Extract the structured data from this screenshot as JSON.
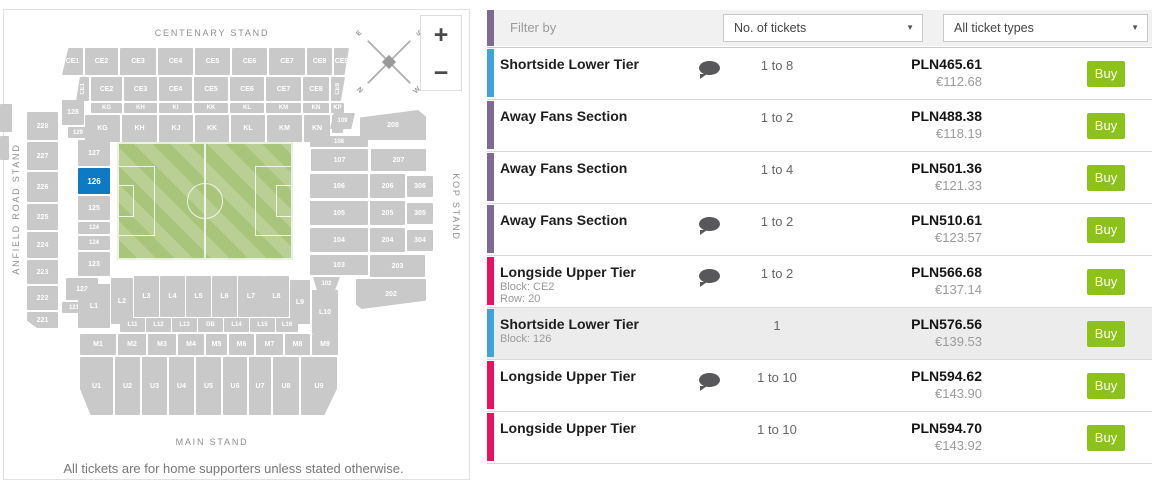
{
  "colors": {
    "buy_green": "#8dc21a",
    "selected_block": "#0e7ac4",
    "block_gray": "#c9c9c9",
    "pitch_green": "#a9c57c",
    "accent_purple": "#7e6b92",
    "accent_blue": "#41a3da",
    "accent_pink": "#e8135f"
  },
  "map": {
    "stands": {
      "top": "CENTENARY STAND",
      "left": "ANFIELD ROAD STAND",
      "right": "KOP STAND",
      "bottom": "MAIN STAND"
    },
    "footer_note": "All tickets are for home supporters unless stated otherwise.",
    "zoom_in": "+",
    "zoom_out": "−",
    "compass": {
      "nw": "E",
      "ne": "S",
      "sw": "N",
      "se": "W"
    },
    "selected_block": "126",
    "blocks": [
      {
        "label": "CE1",
        "x": 62,
        "y": 48,
        "w": 21,
        "h": 27,
        "cls": "sl"
      },
      {
        "label": "CE2",
        "x": 85,
        "y": 48,
        "w": 33,
        "h": 27
      },
      {
        "label": "CE3",
        "x": 120,
        "y": 48,
        "w": 36,
        "h": 27
      },
      {
        "label": "CE4",
        "x": 158,
        "y": 48,
        "w": 35,
        "h": 27
      },
      {
        "label": "CE5",
        "x": 195,
        "y": 48,
        "w": 35,
        "h": 27
      },
      {
        "label": "CE6",
        "x": 232,
        "y": 48,
        "w": 35,
        "h": 27
      },
      {
        "label": "CE7",
        "x": 269,
        "y": 48,
        "w": 36,
        "h": 27
      },
      {
        "label": "CE8",
        "x": 307,
        "y": 48,
        "w": 25,
        "h": 27
      },
      {
        "label": "CE9",
        "x": 334,
        "y": 48,
        "w": 15,
        "h": 27,
        "cls": "sr"
      },
      {
        "label": "CE1",
        "x": 76,
        "y": 77,
        "w": 13,
        "h": 24,
        "cls": "v sl"
      },
      {
        "label": "CE2",
        "x": 91,
        "y": 77,
        "w": 31,
        "h": 24
      },
      {
        "label": "CE3",
        "x": 124,
        "y": 77,
        "w": 33,
        "h": 24
      },
      {
        "label": "CE4",
        "x": 159,
        "y": 77,
        "w": 33,
        "h": 24
      },
      {
        "label": "CE5",
        "x": 194,
        "y": 77,
        "w": 34,
        "h": 24
      },
      {
        "label": "CE6",
        "x": 230,
        "y": 77,
        "w": 34,
        "h": 24
      },
      {
        "label": "CE7",
        "x": 266,
        "y": 77,
        "w": 35,
        "h": 24
      },
      {
        "label": "CE8",
        "x": 303,
        "y": 77,
        "w": 26,
        "h": 24
      },
      {
        "label": "CE9",
        "x": 331,
        "y": 77,
        "w": 14,
        "h": 24,
        "cls": "v sr"
      },
      {
        "label": "KG",
        "x": 91,
        "y": 103,
        "w": 31,
        "h": 10,
        "cls": "tiny"
      },
      {
        "label": "KH",
        "x": 124,
        "y": 103,
        "w": 33,
        "h": 10,
        "cls": "tiny"
      },
      {
        "label": "KI",
        "x": 159,
        "y": 103,
        "w": 33,
        "h": 10,
        "cls": "tiny"
      },
      {
        "label": "KK",
        "x": 194,
        "y": 103,
        "w": 34,
        "h": 10,
        "cls": "tiny"
      },
      {
        "label": "KL",
        "x": 230,
        "y": 103,
        "w": 34,
        "h": 10,
        "cls": "tiny"
      },
      {
        "label": "KM",
        "x": 266,
        "y": 103,
        "w": 35,
        "h": 10,
        "cls": "tiny"
      },
      {
        "label": "KN",
        "x": 303,
        "y": 103,
        "w": 26,
        "h": 10,
        "cls": "tiny"
      },
      {
        "label": "KP",
        "x": 331,
        "y": 103,
        "w": 13,
        "h": 10,
        "cls": "tiny"
      },
      {
        "label": "KG",
        "x": 85,
        "y": 115,
        "w": 35,
        "h": 27
      },
      {
        "label": "KH",
        "x": 122,
        "y": 115,
        "w": 35,
        "h": 27
      },
      {
        "label": "KJ",
        "x": 159,
        "y": 115,
        "w": 34,
        "h": 27
      },
      {
        "label": "KK",
        "x": 195,
        "y": 115,
        "w": 34,
        "h": 27
      },
      {
        "label": "KL",
        "x": 231,
        "y": 115,
        "w": 34,
        "h": 27
      },
      {
        "label": "KM",
        "x": 267,
        "y": 115,
        "w": 35,
        "h": 27
      },
      {
        "label": "KN",
        "x": 304,
        "y": 115,
        "w": 26,
        "h": 27
      },
      {
        "label": "KP",
        "x": 332,
        "y": 115,
        "w": 15,
        "h": 18,
        "cls": "sr"
      },
      {
        "label": "128",
        "x": 62,
        "y": 100,
        "w": 22,
        "h": 25
      },
      {
        "label": "129",
        "x": 68,
        "y": 127,
        "w": 20,
        "h": 11,
        "cls": "tiny"
      },
      {
        "label": "228",
        "x": 27,
        "y": 112,
        "w": 31,
        "h": 28
      },
      {
        "label": "227",
        "x": 27,
        "y": 142,
        "w": 31,
        "h": 28
      },
      {
        "label": "226",
        "x": 27,
        "y": 172,
        "w": 31,
        "h": 30
      },
      {
        "label": "225",
        "x": 27,
        "y": 204,
        "w": 31,
        "h": 26
      },
      {
        "label": "224",
        "x": 27,
        "y": 232,
        "w": 31,
        "h": 26
      },
      {
        "label": "223",
        "x": 27,
        "y": 260,
        "w": 31,
        "h": 24
      },
      {
        "label": "222",
        "x": 27,
        "y": 286,
        "w": 31,
        "h": 24
      },
      {
        "label": "221",
        "x": 27,
        "y": 312,
        "w": 31,
        "h": 16,
        "cls": "cbl"
      },
      {
        "label": "127",
        "x": 78,
        "y": 140,
        "w": 32,
        "h": 26
      },
      {
        "label": "126",
        "x": 78,
        "y": 168,
        "w": 32,
        "h": 26,
        "cls": "sel"
      },
      {
        "label": "125",
        "x": 78,
        "y": 196,
        "w": 32,
        "h": 24
      },
      {
        "label": "124",
        "x": 78,
        "y": 222,
        "w": 32,
        "h": 12,
        "cls": "tiny"
      },
      {
        "label": "124",
        "x": 78,
        "y": 236,
        "w": 32,
        "h": 14,
        "cls": "tiny"
      },
      {
        "label": "123",
        "x": 78,
        "y": 252,
        "w": 32,
        "h": 24
      },
      {
        "label": "122",
        "x": 66,
        "y": 278,
        "w": 32,
        "h": 22
      },
      {
        "label": "121",
        "x": 62,
        "y": 302,
        "w": 24,
        "h": 11,
        "cls": "tiny"
      },
      {
        "label": "",
        "x": 0,
        "y": 104,
        "w": 12,
        "h": 28
      },
      {
        "label": "",
        "x": 0,
        "y": 136,
        "w": 9,
        "h": 24
      },
      {
        "label": "109",
        "x": 330,
        "y": 113,
        "w": 25,
        "h": 16,
        "cls": "tiny p109"
      },
      {
        "label": "208",
        "x": 360,
        "y": 110,
        "w": 66,
        "h": 30,
        "cls": "p208"
      },
      {
        "label": "108",
        "x": 310,
        "y": 136,
        "w": 58,
        "h": 11,
        "cls": "tiny"
      },
      {
        "label": "107",
        "x": 311,
        "y": 149,
        "w": 57,
        "h": 22
      },
      {
        "label": "207",
        "x": 371,
        "y": 149,
        "w": 55,
        "h": 22
      },
      {
        "label": "106",
        "x": 310,
        "y": 174,
        "w": 58,
        "h": 24
      },
      {
        "label": "206",
        "x": 370,
        "y": 174,
        "w": 35,
        "h": 24
      },
      {
        "label": "306",
        "x": 407,
        "y": 176,
        "w": 26,
        "h": 21
      },
      {
        "label": "105",
        "x": 310,
        "y": 201,
        "w": 58,
        "h": 24
      },
      {
        "label": "205",
        "x": 370,
        "y": 201,
        "w": 35,
        "h": 24
      },
      {
        "label": "305",
        "x": 407,
        "y": 203,
        "w": 26,
        "h": 21
      },
      {
        "label": "104",
        "x": 310,
        "y": 228,
        "w": 58,
        "h": 24
      },
      {
        "label": "204",
        "x": 370,
        "y": 228,
        "w": 35,
        "h": 24
      },
      {
        "label": "304",
        "x": 407,
        "y": 230,
        "w": 26,
        "h": 21
      },
      {
        "label": "103",
        "x": 310,
        "y": 255,
        "w": 58,
        "h": 20
      },
      {
        "label": "203",
        "x": 370,
        "y": 255,
        "w": 55,
        "h": 22
      },
      {
        "label": "102",
        "x": 313,
        "y": 277,
        "w": 27,
        "h": 13,
        "cls": "tiny p102"
      },
      {
        "label": "202",
        "x": 356,
        "y": 279,
        "w": 70,
        "h": 30,
        "cls": "p202"
      },
      {
        "label": "L1",
        "x": 78,
        "y": 284,
        "w": 32,
        "h": 44,
        "cls": "ctl"
      },
      {
        "label": "L2",
        "x": 111,
        "y": 278,
        "w": 22,
        "h": 46
      },
      {
        "label": "L3",
        "x": 134,
        "y": 276,
        "w": 25,
        "h": 41
      },
      {
        "label": "L4",
        "x": 160,
        "y": 276,
        "w": 25,
        "h": 41
      },
      {
        "label": "L5",
        "x": 186,
        "y": 276,
        "w": 25,
        "h": 41
      },
      {
        "label": "L6",
        "x": 212,
        "y": 276,
        "w": 25,
        "h": 41
      },
      {
        "label": "L7",
        "x": 238,
        "y": 276,
        "w": 26,
        "h": 41
      },
      {
        "label": "L8",
        "x": 264,
        "y": 276,
        "w": 25,
        "h": 41
      },
      {
        "label": "L9",
        "x": 290,
        "y": 280,
        "w": 20,
        "h": 44
      },
      {
        "label": "L10",
        "x": 312,
        "y": 290,
        "w": 26,
        "h": 44
      },
      {
        "label": "L11",
        "x": 120,
        "y": 318,
        "w": 25,
        "h": 14,
        "cls": "tiny"
      },
      {
        "label": "L12",
        "x": 146,
        "y": 318,
        "w": 25,
        "h": 14,
        "cls": "tiny"
      },
      {
        "label": "L13",
        "x": 172,
        "y": 318,
        "w": 25,
        "h": 14,
        "cls": "tiny"
      },
      {
        "label": "DB",
        "x": 198,
        "y": 318,
        "w": 25,
        "h": 14,
        "cls": "tiny"
      },
      {
        "label": "L14",
        "x": 224,
        "y": 318,
        "w": 25,
        "h": 14,
        "cls": "tiny"
      },
      {
        "label": "L15",
        "x": 250,
        "y": 318,
        "w": 25,
        "h": 14,
        "cls": "tiny"
      },
      {
        "label": "L16",
        "x": 276,
        "y": 318,
        "w": 22,
        "h": 14,
        "cls": "tiny"
      },
      {
        "label": "M1",
        "x": 80,
        "y": 334,
        "w": 36,
        "h": 21
      },
      {
        "label": "M2",
        "x": 118,
        "y": 334,
        "w": 28,
        "h": 21
      },
      {
        "label": "M3",
        "x": 148,
        "y": 334,
        "w": 28,
        "h": 21
      },
      {
        "label": "M4",
        "x": 178,
        "y": 334,
        "w": 26,
        "h": 21
      },
      {
        "label": "M5",
        "x": 206,
        "y": 334,
        "w": 21,
        "h": 21
      },
      {
        "label": "M6",
        "x": 229,
        "y": 334,
        "w": 25,
        "h": 21
      },
      {
        "label": "M7",
        "x": 256,
        "y": 334,
        "w": 27,
        "h": 21
      },
      {
        "label": "M8",
        "x": 285,
        "y": 334,
        "w": 25,
        "h": 21
      },
      {
        "label": "M9",
        "x": 312,
        "y": 334,
        "w": 26,
        "h": 21
      },
      {
        "label": "U1",
        "x": 80,
        "y": 357,
        "w": 33,
        "h": 58,
        "cls": "cbl"
      },
      {
        "label": "U2",
        "x": 115,
        "y": 357,
        "w": 25,
        "h": 58
      },
      {
        "label": "U3",
        "x": 142,
        "y": 357,
        "w": 25,
        "h": 58
      },
      {
        "label": "U4",
        "x": 169,
        "y": 357,
        "w": 25,
        "h": 58
      },
      {
        "label": "U5",
        "x": 196,
        "y": 357,
        "w": 25,
        "h": 58
      },
      {
        "label": "U6",
        "x": 223,
        "y": 357,
        "w": 24,
        "h": 58
      },
      {
        "label": "U7",
        "x": 249,
        "y": 357,
        "w": 22,
        "h": 58
      },
      {
        "label": "U8",
        "x": 273,
        "y": 357,
        "w": 26,
        "h": 58
      },
      {
        "label": "U9",
        "x": 301,
        "y": 357,
        "w": 36,
        "h": 58,
        "cls": "cbr"
      }
    ]
  },
  "filter": {
    "label": "Filter by",
    "tickets_dropdown": {
      "value": "No. of tickets",
      "caret": "▼"
    },
    "types_dropdown": {
      "value": "All ticket types",
      "caret": "▼"
    },
    "accent": "#7e6b92"
  },
  "tickets": [
    {
      "name": "Shortside Lower Tier",
      "details": [],
      "has_note": true,
      "quantity": "1 to 8",
      "price_pln": "PLN465.61",
      "price_eur": "€112.68",
      "buy": "Buy",
      "bar_color": "#41a3da",
      "selected": false
    },
    {
      "name": "Away Fans Section",
      "details": [],
      "has_note": false,
      "quantity": "1 to 2",
      "price_pln": "PLN488.38",
      "price_eur": "€118.19",
      "buy": "Buy",
      "bar_color": "#7e6b92",
      "selected": false
    },
    {
      "name": "Away Fans Section",
      "details": [],
      "has_note": false,
      "quantity": "1 to 4",
      "price_pln": "PLN501.36",
      "price_eur": "€121.33",
      "buy": "Buy",
      "bar_color": "#7e6b92",
      "selected": false
    },
    {
      "name": "Away Fans Section",
      "details": [],
      "has_note": true,
      "quantity": "1 to 2",
      "price_pln": "PLN510.61",
      "price_eur": "€123.57",
      "buy": "Buy",
      "bar_color": "#7e6b92",
      "selected": false
    },
    {
      "name": "Longside Upper Tier",
      "details": [
        "Block: CE2",
        "Row: 20"
      ],
      "has_note": true,
      "quantity": "1 to 2",
      "price_pln": "PLN566.68",
      "price_eur": "€137.14",
      "buy": "Buy",
      "bar_color": "#e8135f",
      "selected": false
    },
    {
      "name": "Shortside Lower Tier",
      "details": [
        "Block: 126"
      ],
      "has_note": false,
      "quantity": "1",
      "price_pln": "PLN576.56",
      "price_eur": "€139.53",
      "buy": "Buy",
      "bar_color": "#41a3da",
      "selected": true
    },
    {
      "name": "Longside Upper Tier",
      "details": [],
      "has_note": true,
      "quantity": "1 to 10",
      "price_pln": "PLN594.62",
      "price_eur": "€143.90",
      "buy": "Buy",
      "bar_color": "#e8135f",
      "selected": false
    },
    {
      "name": "Longside Upper Tier",
      "details": [],
      "has_note": false,
      "quantity": "1 to 10",
      "price_pln": "PLN594.70",
      "price_eur": "€143.92",
      "buy": "Buy",
      "bar_color": "#e8135f",
      "selected": false
    }
  ]
}
